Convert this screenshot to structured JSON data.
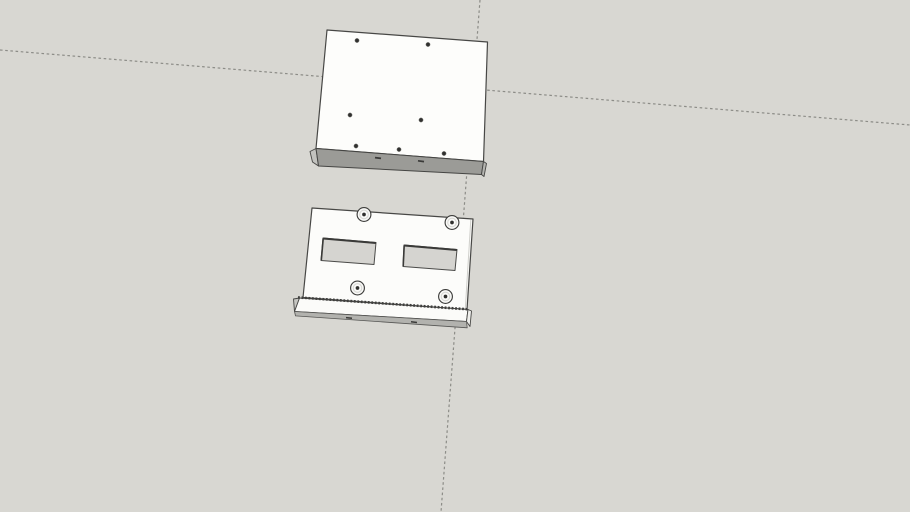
{
  "scene": {
    "canvas": {
      "width": 910,
      "height": 512
    },
    "background_color": "#d8d7d2",
    "axis_lines": [
      {
        "name": "axis-line-horizontal-dashed",
        "x1": 0,
        "y1": 50,
        "x2": 910,
        "y2": 125,
        "stroke": "#8c8c87",
        "strokeWidth": 1.2,
        "dash": "2.6 2.6"
      },
      {
        "name": "axis-line-vertical-dashed",
        "x1": 480,
        "y1": 0,
        "x2": 441,
        "y2": 512,
        "stroke": "#8c8c87",
        "strokeWidth": 1.2,
        "dash": "2.6 2.6"
      }
    ],
    "objects": [
      {
        "name": "model-top-plate",
        "shapes": [
          {
            "type": "polygon",
            "name": "plate-top-face",
            "points": "327,30 487.5,42 483.5,161.5 316,148.5",
            "fill": "#fdfdfb",
            "stroke": "#474745",
            "strokeWidth": 1.2
          },
          {
            "type": "polygon",
            "name": "plate-left-edge-face",
            "points": "310,151.5 316,148.5 318.5,166 312.5,162",
            "fill": "#c2c2be",
            "stroke": "#474745",
            "strokeWidth": 0.9
          },
          {
            "type": "polygon",
            "name": "plate-front-edge-face",
            "points": "316,148.5 483.5,161.5 481.5,174.5 318.5,166",
            "fill": "#9b9b97",
            "stroke": "#454543",
            "strokeWidth": 1
          },
          {
            "type": "polygon",
            "name": "plate-right-edge-sliver",
            "points": "483.5,161.5 486.5,163.5 484,176.5 481.5,174.5",
            "fill": "#b4b4b0",
            "stroke": "#474745",
            "strokeWidth": 0.9
          },
          {
            "type": "circle",
            "name": "screw-hole-1",
            "cx": 357,
            "cy": 40.5,
            "r": 2.1,
            "fill": "#31312f",
            "stroke": "#7e7e7a",
            "strokeWidth": 0.5
          },
          {
            "type": "circle",
            "name": "screw-hole-2",
            "cx": 428,
            "cy": 44.5,
            "r": 2.1,
            "fill": "#31312f",
            "stroke": "#7e7e7a",
            "strokeWidth": 0.5
          },
          {
            "type": "circle",
            "name": "screw-hole-3",
            "cx": 350,
            "cy": 115,
            "r": 2.1,
            "fill": "#31312f",
            "stroke": "#7e7e7a",
            "strokeWidth": 0.5
          },
          {
            "type": "circle",
            "name": "screw-hole-4",
            "cx": 421,
            "cy": 120,
            "r": 2.1,
            "fill": "#31312f",
            "stroke": "#7e7e7a",
            "strokeWidth": 0.5
          },
          {
            "type": "circle",
            "name": "screw-hole-5",
            "cx": 356,
            "cy": 146,
            "r": 2.1,
            "fill": "#31312f",
            "stroke": "#7e7e7a",
            "strokeWidth": 0.5
          },
          {
            "type": "circle",
            "name": "screw-hole-6",
            "cx": 399,
            "cy": 149.5,
            "r": 2.1,
            "fill": "#31312f",
            "stroke": "#7e7e7a",
            "strokeWidth": 0.5
          },
          {
            "type": "circle",
            "name": "screw-hole-7",
            "cx": 444,
            "cy": 153.5,
            "r": 2.1,
            "fill": "#31312f",
            "stroke": "#7e7e7a",
            "strokeWidth": 0.5
          },
          {
            "type": "line",
            "name": "edge-hole-mark-1",
            "x1": 375,
            "y1": 157.6,
            "x2": 381,
            "y2": 158.4,
            "stroke": "#3a3a38",
            "strokeWidth": 1.7
          },
          {
            "type": "line",
            "name": "edge-hole-mark-2",
            "x1": 418,
            "y1": 160.8,
            "x2": 424,
            "y2": 161.6,
            "stroke": "#3a3a38",
            "strokeWidth": 1.7
          }
        ]
      },
      {
        "name": "model-bottom-bracket",
        "shapes": [
          {
            "type": "polygon",
            "name": "bracket-front-face",
            "points": "312,208 473,219 467,309.5 303,297.5",
            "fill": "#fcfcfa",
            "stroke": "#474745",
            "strokeWidth": 1.2
          },
          {
            "type": "line",
            "name": "bracket-right-fold-line",
            "x1": 470.8,
            "y1": 219.8,
            "x2": 465.3,
            "y2": 308.6,
            "stroke": "#d0d0cc",
            "strokeWidth": 1
          },
          {
            "type": "polygon",
            "name": "cutout-left",
            "points": "323,238 376,242.5 374,264.5 321,260.5",
            "fill": "#d5d4d0",
            "stroke": "#4a4a48",
            "strokeWidth": 1
          },
          {
            "type": "line",
            "name": "cutout-left-shadow-top",
            "x1": 323.2,
            "y1": 238.5,
            "x2": 375.8,
            "y2": 243,
            "stroke": "#3a3a38",
            "strokeWidth": 2
          },
          {
            "type": "line",
            "name": "cutout-left-shadow-side",
            "x1": 323.2,
            "y1": 238.5,
            "x2": 321.3,
            "y2": 260.2,
            "stroke": "#3a3a38",
            "strokeWidth": 1.6
          },
          {
            "type": "polygon",
            "name": "cutout-right",
            "points": "404,245 457,249.5 455,270.5 403,266.5",
            "fill": "#d5d4d0",
            "stroke": "#4a4a48",
            "strokeWidth": 1
          },
          {
            "type": "line",
            "name": "cutout-right-shadow-top",
            "x1": 404.2,
            "y1": 245.5,
            "x2": 456.8,
            "y2": 250,
            "stroke": "#3a3a38",
            "strokeWidth": 2
          },
          {
            "type": "line",
            "name": "cutout-right-shadow-side",
            "x1": 404.2,
            "y1": 245.5,
            "x2": 403.2,
            "y2": 266.2,
            "stroke": "#3a3a38",
            "strokeWidth": 1.6
          },
          {
            "type": "polygon",
            "name": "rail-left-cap",
            "points": "293.5,299 299.5,298 300.5,312.5 294.5,311.5",
            "fill": "#c6c6c2",
            "stroke": "#474745",
            "strokeWidth": 0.9
          },
          {
            "type": "polygon",
            "name": "rail-front-face",
            "points": "299.5,298 468,309.5 466.5,321.5 294.5,311.5",
            "fill": "#fbfbf9",
            "stroke": "#454543",
            "strokeWidth": 1
          },
          {
            "type": "polygon",
            "name": "rail-right-cap",
            "points": "468,309.5 471.5,311 470,326.5 466.5,321.5",
            "fill": "#efefec",
            "stroke": "#474745",
            "strokeWidth": 0.9
          },
          {
            "type": "polygon",
            "name": "rail-bottom-face",
            "points": "294.5,311.5 466.5,321.5 467.2,327.8 295.5,315.9",
            "fill": "#b2b2ae",
            "stroke": "#565654",
            "strokeWidth": 0.8
          },
          {
            "type": "line",
            "name": "rail-serrated-edge",
            "x1": 298,
            "y1": 297.4,
            "x2": 468,
            "y2": 309.3,
            "stroke": "#3f3f3d",
            "strokeWidth": 2.6,
            "dash": "1.8 1.7"
          },
          {
            "type": "line",
            "name": "rail-bottom-mark-1",
            "x1": 346,
            "y1": 317.6,
            "x2": 352,
            "y2": 318.3,
            "stroke": "#3a3a38",
            "strokeWidth": 1.5
          },
          {
            "type": "line",
            "name": "rail-bottom-mark-2",
            "x1": 411,
            "y1": 321.8,
            "x2": 417,
            "y2": 322.5,
            "stroke": "#3a3a38",
            "strokeWidth": 1.5
          },
          {
            "type": "circle",
            "name": "standoff-1-body",
            "cx": 364,
            "cy": 214.5,
            "r": 6.9,
            "fill": "#fafaf8",
            "stroke": "#3e3e3c",
            "strokeWidth": 1.15
          },
          {
            "type": "circle",
            "name": "standoff-1-rim",
            "cx": 364,
            "cy": 214.5,
            "r": 4.3,
            "fill": "none",
            "stroke": "#d8d8d4",
            "strokeWidth": 1.1
          },
          {
            "type": "circle",
            "name": "standoff-1-hole",
            "cx": 364,
            "cy": 214.5,
            "r": 1.85,
            "fill": "#2f2f2d"
          },
          {
            "type": "circle",
            "name": "standoff-2-body",
            "cx": 452,
            "cy": 222.5,
            "r": 6.9,
            "fill": "#fafaf8",
            "stroke": "#3e3e3c",
            "strokeWidth": 1.15
          },
          {
            "type": "circle",
            "name": "standoff-2-rim",
            "cx": 452,
            "cy": 222.5,
            "r": 4.3,
            "fill": "none",
            "stroke": "#d8d8d4",
            "strokeWidth": 1.1
          },
          {
            "type": "circle",
            "name": "standoff-2-hole",
            "cx": 452,
            "cy": 222.5,
            "r": 1.85,
            "fill": "#2f2f2d"
          },
          {
            "type": "circle",
            "name": "standoff-3-body",
            "cx": 357.5,
            "cy": 288,
            "r": 6.9,
            "fill": "#fafaf8",
            "stroke": "#3e3e3c",
            "strokeWidth": 1.15
          },
          {
            "type": "circle",
            "name": "standoff-3-rim",
            "cx": 357.5,
            "cy": 288,
            "r": 4.3,
            "fill": "none",
            "stroke": "#d8d8d4",
            "strokeWidth": 1.1
          },
          {
            "type": "circle",
            "name": "standoff-3-hole",
            "cx": 357.5,
            "cy": 288,
            "r": 1.85,
            "fill": "#2f2f2d"
          },
          {
            "type": "circle",
            "name": "standoff-4-body",
            "cx": 445.5,
            "cy": 296.5,
            "r": 6.9,
            "fill": "#fafaf8",
            "stroke": "#3e3e3c",
            "strokeWidth": 1.15
          },
          {
            "type": "circle",
            "name": "standoff-4-rim",
            "cx": 445.5,
            "cy": 296.5,
            "r": 4.3,
            "fill": "none",
            "stroke": "#d8d8d4",
            "strokeWidth": 1.1
          },
          {
            "type": "circle",
            "name": "standoff-4-hole",
            "cx": 445.5,
            "cy": 296.5,
            "r": 1.85,
            "fill": "#2f2f2d"
          }
        ]
      }
    ]
  }
}
